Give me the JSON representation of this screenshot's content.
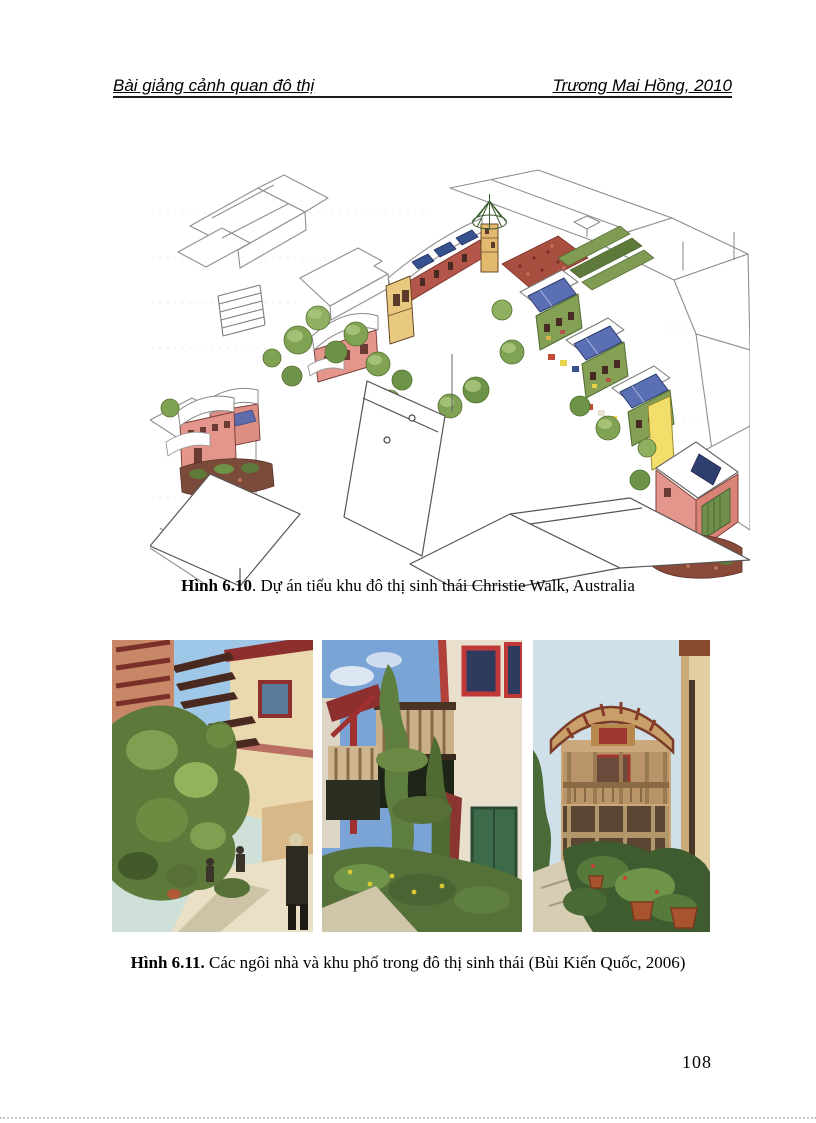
{
  "header": {
    "left": "Bài giảng cảnh quan đô thị",
    "right": "Trương Mai Hồng, 2010"
  },
  "figures": {
    "fig610": {
      "label": "Hình 6.10",
      "text": ". Dự án tiểu khu đô thị sinh thái Christie Walk, Australia"
    },
    "fig611": {
      "label": "Hình 6.11.",
      "text": "  Các ngôi nhà và khu phố trong đô thị sinh thái (Bùi Kiến Quốc, 2006)"
    }
  },
  "page_number": "108",
  "illustration_colors": {
    "sketch_line": "#8f8f8f",
    "foreground_line": "#555555",
    "building_pink": "#e5968c",
    "wall_red": "#b5564a",
    "roof_white": "#ffffff",
    "solar_blue": "#5b6fb5",
    "solar_dark_blue": "#37508f",
    "tree_green": "#7fa352",
    "facade_green": "#84a055",
    "wall_yellow": "#f2df6b",
    "tower_tan": "#e2b96e",
    "rooftop_red": "#a84f3f"
  }
}
